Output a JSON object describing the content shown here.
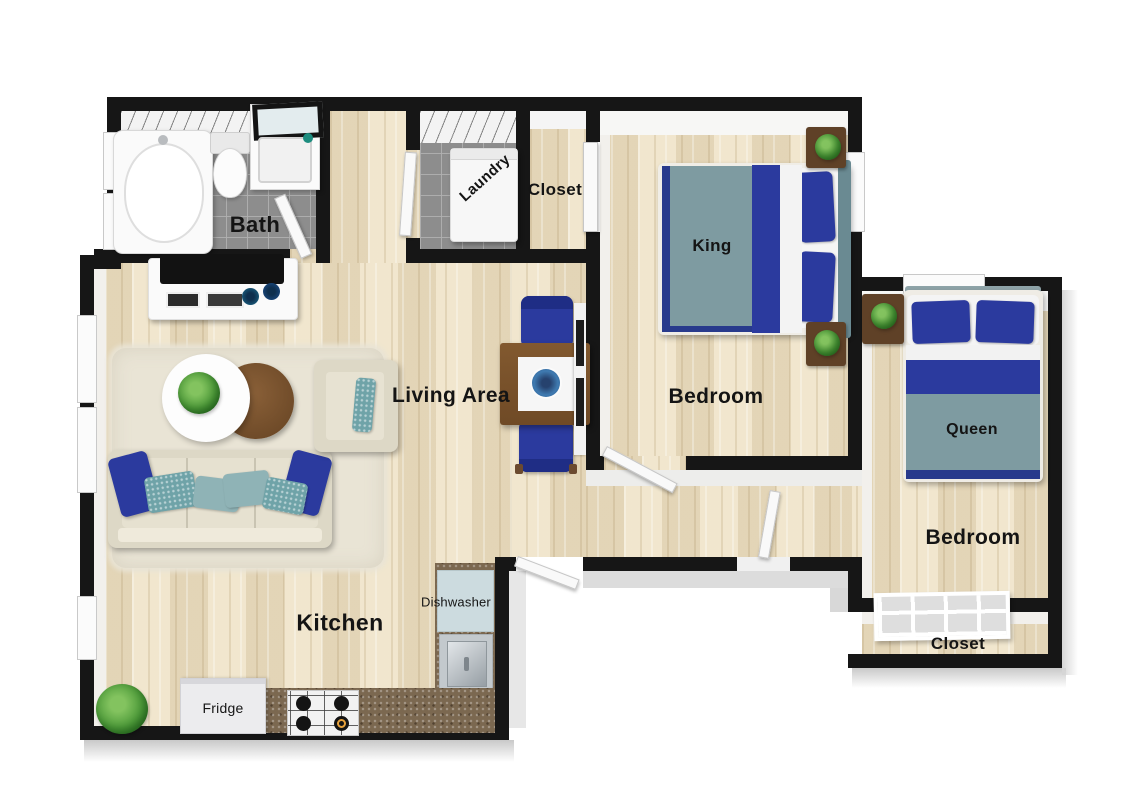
{
  "plan": {
    "type": "apartment-floor-plan-3d-top-view",
    "palette": {
      "wall": "#161616",
      "wood_floor": "#ecdfc2",
      "tile_floor": "#8d8d8d",
      "accent_blue": "#2b3a9e",
      "bed_teal": "#7e9ba1",
      "granite_counter": "#7b6850",
      "rug": "#e9e4d5",
      "sofa_beige": "#ddd8c6",
      "plant_green": "#4e9b3a",
      "nightstand_brown": "#5f4127"
    },
    "labels": {
      "bath": "Bath",
      "laundry": "Laundry",
      "closet_top": "Closet",
      "king": "King",
      "bedroom_king": "Bedroom",
      "queen": "Queen",
      "bedroom_queen": "Bedroom",
      "closet_bottom": "Closet",
      "living": "Living Area",
      "kitchen": "Kitchen",
      "dishwasher": "Dishwasher",
      "fridge": "Fridge"
    }
  }
}
